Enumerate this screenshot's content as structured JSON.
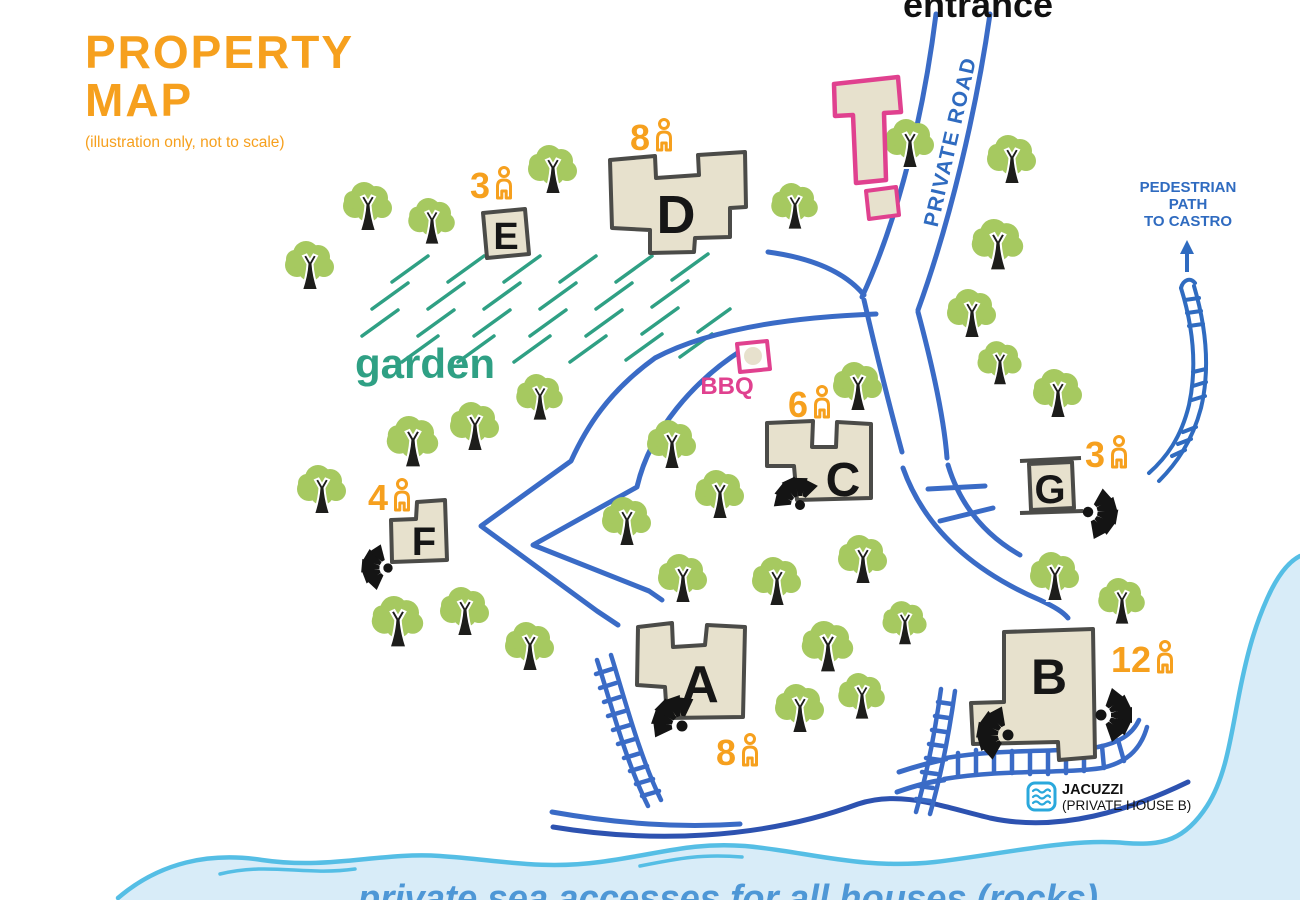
{
  "title": {
    "line1": "PROPERTY",
    "line2": "MAP",
    "subtitle": "(illustration only, not to scale)"
  },
  "labels": {
    "entrance": "entrance",
    "private_road": "PRIVATE ROAD",
    "garden": "garden",
    "bbq": "BBQ",
    "pedestrian_line1": "PEDESTRIAN",
    "pedestrian_line2": "PATH",
    "pedestrian_line3": "TO CASTRO",
    "jacuzzi": "JACUZZI",
    "jacuzzi_sub": "(PRIVATE HOUSE B)",
    "sea": "private sea accesses for all houses (rocks)"
  },
  "houses": [
    {
      "label": "A",
      "capacity": "8"
    },
    {
      "label": "B",
      "capacity": "12"
    },
    {
      "label": "C",
      "capacity": "6"
    },
    {
      "label": "D",
      "capacity": "8"
    },
    {
      "label": "E",
      "capacity": "3"
    },
    {
      "label": "F",
      "capacity": "4"
    },
    {
      "label": "G",
      "capacity": "3"
    }
  ],
  "colors": {
    "accent_orange": "#F6A01E",
    "garden_teal": "#2FA084",
    "road_blue": "#3A6BC6",
    "label_blue": "#2F6BC0",
    "pink": "#E0418F",
    "house_fill": "#E7E1CD",
    "house_stroke": "#4B4B48",
    "tree_green": "#A6C960",
    "sea_fill": "#D8ECF8",
    "coast_blue": "#55BEE5",
    "sea_text_blue": "#4E97D6"
  }
}
